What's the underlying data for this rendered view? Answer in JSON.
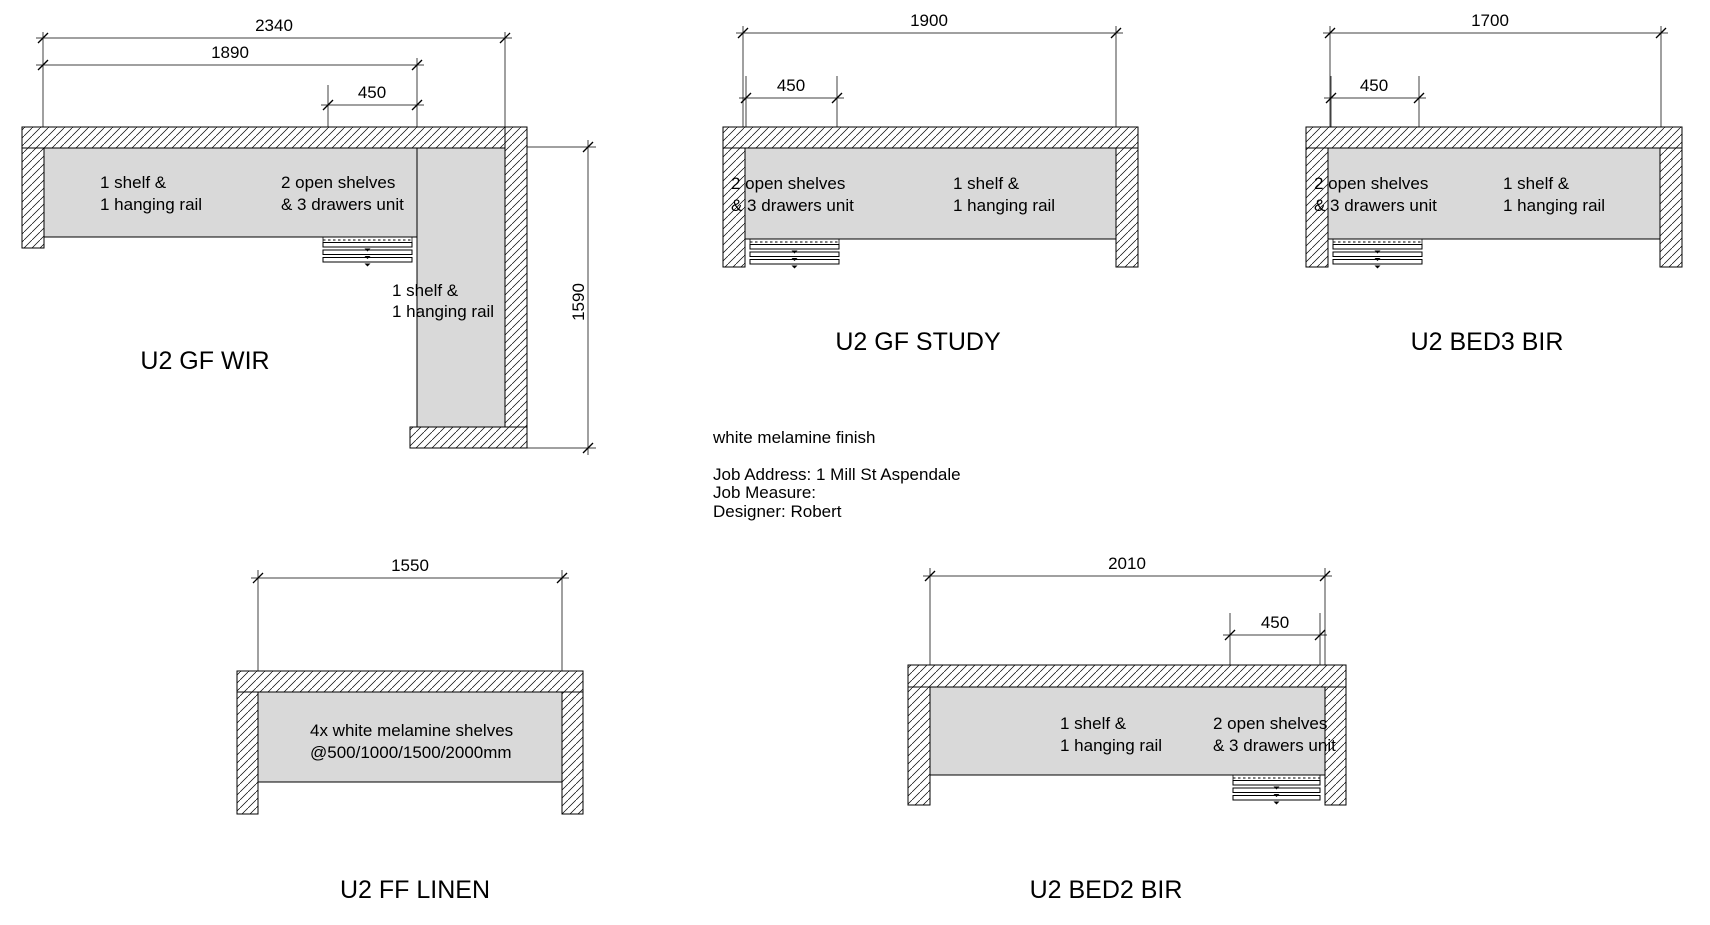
{
  "colors": {
    "background": "#ffffff",
    "interior_fill": "#d9d9d9",
    "line": "#000000",
    "note_accent": "#ff00ff"
  },
  "notes": {
    "finish": "white melamine finish",
    "job_address": "Job Address: 1 Mill St Aspendale",
    "job_measure": "Job Measure:",
    "designer": "Designer: Robert"
  },
  "units": [
    {
      "title": "U2 GF WIR",
      "dimensions": {
        "overall_width": "2340",
        "left_section_width": "1890",
        "drawer_unit_width": "450",
        "return_length": "1590"
      },
      "labels": {
        "left_section": [
          "1 shelf &",
          "1 hanging rail"
        ],
        "drawer_section": [
          "2 open shelves",
          "& 3 drawers unit"
        ],
        "return_section": [
          "1 shelf &",
          "1 hanging rail"
        ]
      }
    },
    {
      "title": "U2 GF STUDY",
      "dimensions": {
        "overall_width": "1900",
        "drawer_unit_width": "450"
      },
      "labels": {
        "drawer_section": [
          "2 open shelves",
          "& 3 drawers unit"
        ],
        "main_section": [
          "1 shelf &",
          "1 hanging rail"
        ]
      }
    },
    {
      "title": "U2 BED3 BIR",
      "dimensions": {
        "overall_width": "1700",
        "drawer_unit_width": "450"
      },
      "labels": {
        "drawer_section": [
          "2 open shelves",
          "& 3 drawers unit"
        ],
        "main_section": [
          "1 shelf &",
          "1 hanging rail"
        ]
      }
    },
    {
      "title": "U2 FF LINEN",
      "dimensions": {
        "overall_width": "1550"
      },
      "labels": {
        "main_section": [
          "4x white melamine shelves",
          "@500/1000/1500/2000mm"
        ]
      }
    },
    {
      "title": "U2 BED2 BIR",
      "dimensions": {
        "overall_width": "2010",
        "drawer_unit_width": "450"
      },
      "labels": {
        "main_section": [
          "1 shelf &",
          "1 hanging rail"
        ],
        "drawer_section": [
          "2 open shelves",
          "& 3 drawers unit"
        ]
      }
    }
  ]
}
